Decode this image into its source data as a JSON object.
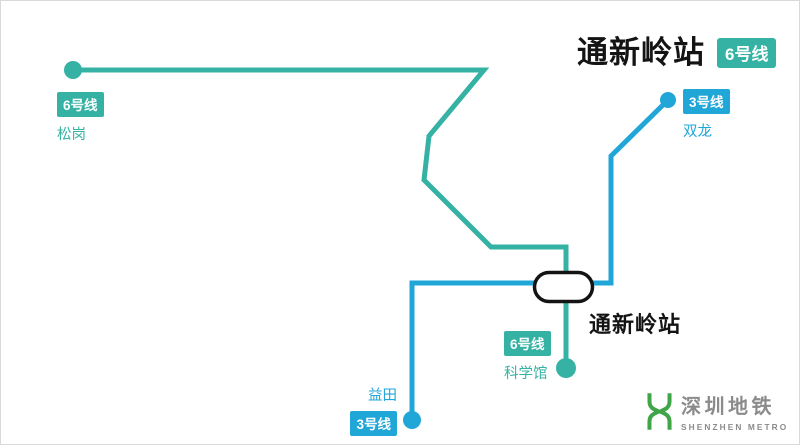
{
  "header": {
    "title": "通新岭站",
    "line_badge": "6号线"
  },
  "colors": {
    "line6_teal": "#35b2a4",
    "line3_blue": "#21a6d8",
    "station_marker_border": "#141414",
    "station_marker_fill": "#ffffff",
    "title_black": "#141414",
    "logo_green": "#3fa548",
    "logo_gray": "#8b8b8b"
  },
  "map": {
    "stations": {
      "songgang": {
        "line_badge": "6号线",
        "name": "松岗"
      },
      "shuanglong": {
        "line_badge": "3号线",
        "name": "双龙"
      },
      "kexueguan": {
        "line_badge": "6号线",
        "name": "科学馆"
      },
      "yitian": {
        "name": "益田",
        "line_badge": "3号线"
      },
      "tongxinling": {
        "name": "通新岭站"
      }
    }
  },
  "logo": {
    "name_cn": "深圳地铁",
    "name_en": "SHENZHEN METRO"
  }
}
